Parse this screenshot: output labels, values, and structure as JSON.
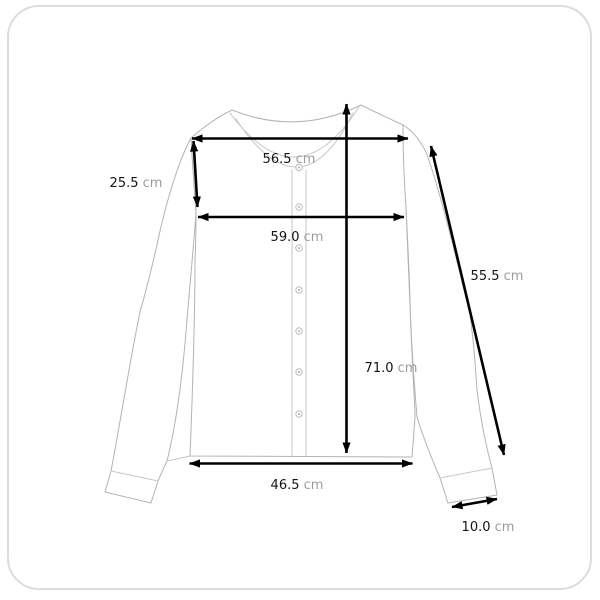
{
  "card": {
    "background": "#ffffff",
    "border_color": "#dcdcdc"
  },
  "colors": {
    "measure_line": "#000000",
    "value_text": "#141414",
    "unit_text": "#9c9c9c",
    "garment_outline": "#b3b3b3",
    "garment_detail": "#c7c7c7"
  },
  "diagram": {
    "subject": "cardigan-measurement-diagram",
    "unit": "cm",
    "measurements": [
      {
        "name": "shoulder-width",
        "value": "56.5",
        "unit": "cm",
        "line": {
          "x1": 192,
          "y1": 138.5,
          "x2": 408,
          "y2": 138.5
        },
        "label": {
          "x": 289,
          "y": 163
        }
      },
      {
        "name": "armhole-depth",
        "value": "25.5",
        "unit": "cm",
        "line": {
          "x1": 193.5,
          "y1": 141,
          "x2": 197.5,
          "y2": 207
        },
        "label": {
          "x": 136,
          "y": 187
        }
      },
      {
        "name": "chest-width",
        "value": "59.0",
        "unit": "cm",
        "line": {
          "x1": 198,
          "y1": 217,
          "x2": 404,
          "y2": 217
        },
        "label": {
          "x": 297,
          "y": 241
        }
      },
      {
        "name": "sleeve-length",
        "value": "55.5",
        "unit": "cm",
        "line": {
          "x1": 431,
          "y1": 146,
          "x2": 504,
          "y2": 455
        },
        "label": {
          "x": 497,
          "y": 280
        }
      },
      {
        "name": "total-length",
        "value": "71.0",
        "unit": "cm",
        "line": {
          "x1": 346.5,
          "y1": 104,
          "x2": 346.5,
          "y2": 453
        },
        "label": {
          "x": 391,
          "y": 372
        }
      },
      {
        "name": "hem-width",
        "value": "46.5",
        "unit": "cm",
        "line": {
          "x1": 189.5,
          "y1": 463.5,
          "x2": 412.5,
          "y2": 463.5
        },
        "label": {
          "x": 297,
          "y": 489
        }
      },
      {
        "name": "cuff-width",
        "value": "10.0",
        "unit": "cm",
        "line": {
          "x1": 452,
          "y1": 507,
          "x2": 497,
          "y2": 499
        },
        "label": {
          "x": 488,
          "y": 531
        }
      }
    ]
  }
}
